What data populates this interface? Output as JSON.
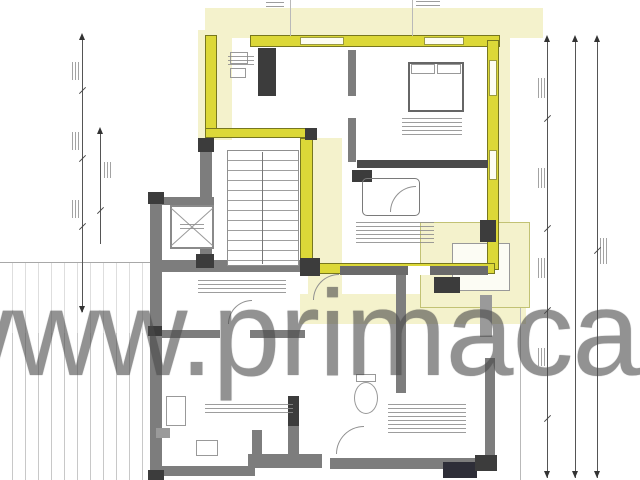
{
  "watermark": {
    "text": "www.primacasa"
  },
  "colors": {
    "highlight_wall": "#dcd838",
    "highlight_wash": "#f4f2cc",
    "wall_gray": "#7d7d7d",
    "wall_dark": "#3c3c3c",
    "line_gray": "#555555",
    "hatch_gray": "#c8c8c8",
    "watermark_gray": "#4a4a4a",
    "background": "#ffffff"
  }
}
